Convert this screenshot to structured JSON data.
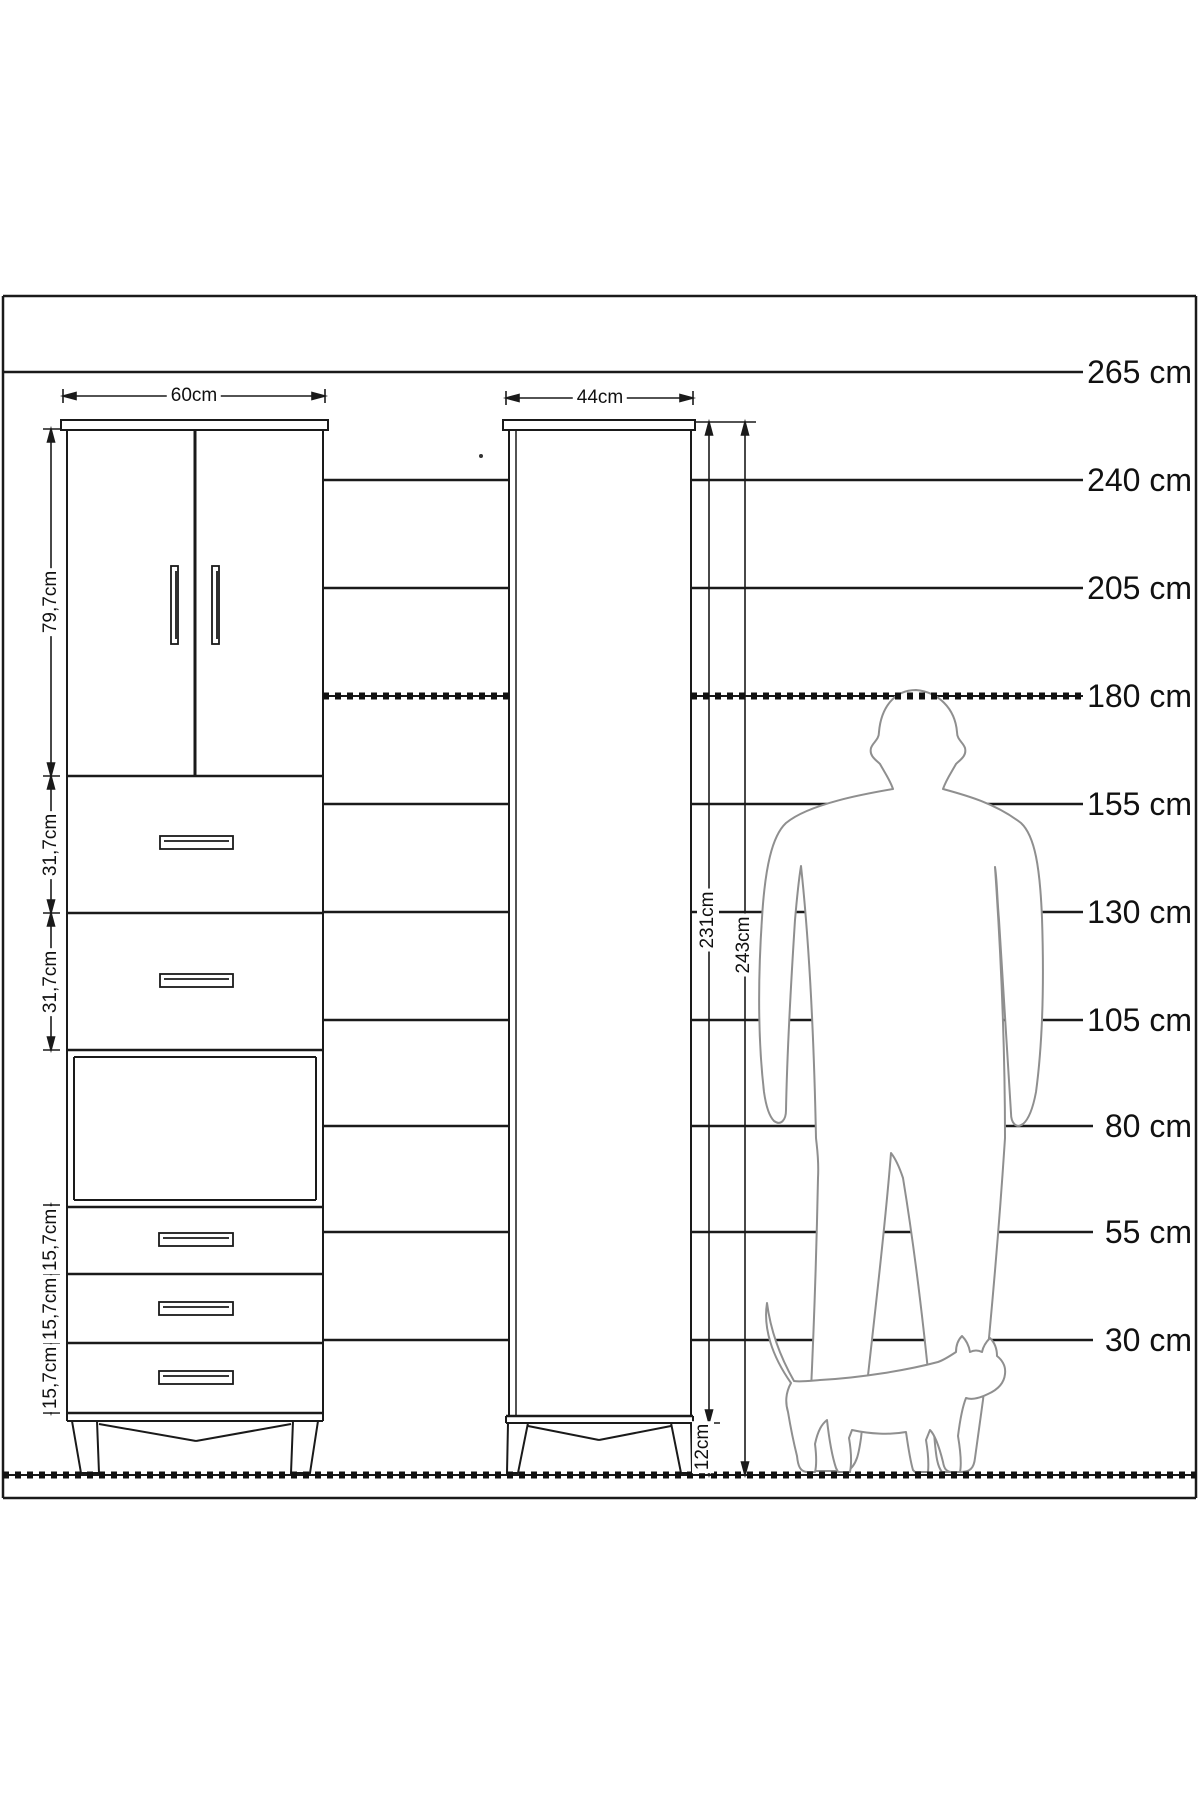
{
  "diagram": {
    "front_view": {
      "width_label": "60cm",
      "section_labels": [
        "79,7cm",
        "31,7cm",
        "31,7cm",
        "15,7cm",
        "15,7cm",
        "15,7cm"
      ]
    },
    "side_view": {
      "width_label": "44cm",
      "carcass_height_label": "231cm",
      "total_height_label": "243cm",
      "leg_height_label": "12cm"
    },
    "height_scale": {
      "rows": [
        {
          "label": "265 cm"
        },
        {
          "label": "240 cm"
        },
        {
          "label": "205 cm"
        },
        {
          "label": "180 cm"
        },
        {
          "label": "155 cm"
        },
        {
          "label": "130 cm"
        },
        {
          "label": "105 cm"
        },
        {
          "label": "80 cm"
        },
        {
          "label": "55 cm"
        },
        {
          "label": "30 cm"
        }
      ]
    },
    "figures": {
      "man_icon": "man-silhouette",
      "cat_icon": "cat-silhouette"
    },
    "colors": {
      "line": "#1a1a1a",
      "silhouette": "#8f8f8f",
      "background": "#ffffff"
    }
  }
}
